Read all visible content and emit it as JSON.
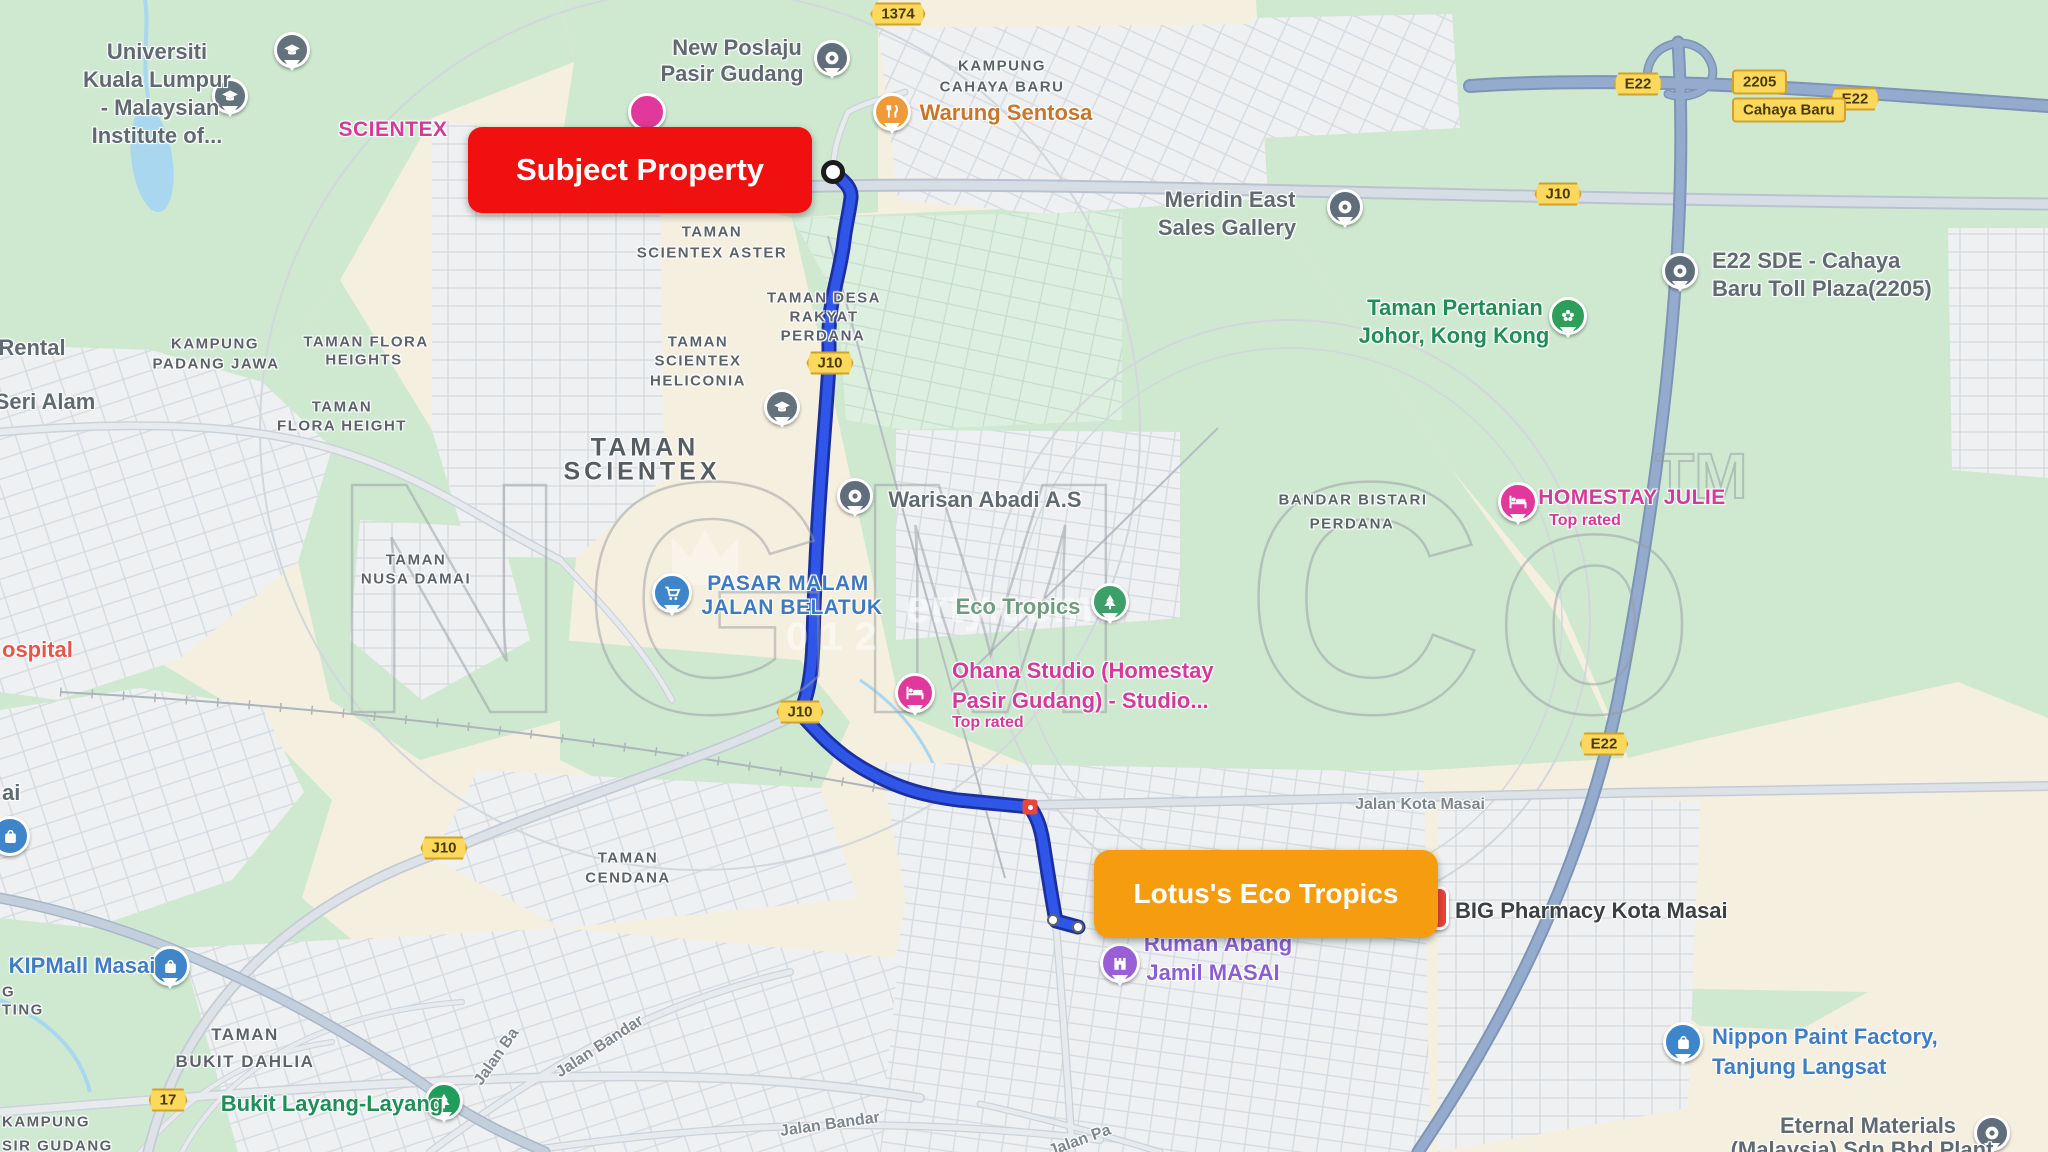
{
  "annotations": {
    "subject_property": "Subject Property",
    "lotus": "Lotus's Eco Tropics"
  },
  "shields": {
    "r1374": "1374",
    "e22": "E22",
    "r2205": "2205",
    "cahaya_baru": "Cahaya Baru",
    "j10": "J10",
    "r17": "17"
  },
  "watermark": {
    "part1": "NGM",
    "part2": "Co",
    "tm": "TM",
    "sub": "erty.com",
    "digits": "012"
  },
  "pois": {
    "universiti_l1": "Universiti",
    "universiti_l2": "Kuala Lumpur",
    "universiti_l3": "- Malaysian",
    "universiti_l4": "Institute of...",
    "new_poslaju_l1": "New Poslaju",
    "new_poslaju_l2": "Pasir Gudang",
    "warung": "Warung Sentosa",
    "scientex_partial": "SCIENTEX",
    "meridin_l1": "Meridin East",
    "meridin_l2": "Sales Gallery",
    "pertanian_l1": "Taman Pertanian",
    "pertanian_l2": "Johor, Kong Kong",
    "toll_l1": "E22 SDE - Cahaya",
    "toll_l2": "Baru Toll Plaza(2205)",
    "homestay_julie": "HOMESTAY JULIE",
    "top_rated": "Top rated",
    "warisan": "Warisan Abadi A.S",
    "pasar_l1": "PASAR MALAM",
    "pasar_l2": "JALAN BELATUK",
    "eco_tropics": "Eco Tropics",
    "ohana_l1": "Ohana Studio (Homestay",
    "ohana_l2": "Pasir Gudang) - Studio...",
    "big_pharmacy": "BIG Pharmacy Kota Masai",
    "ruman_l1": "Ruman Abang",
    "ruman_l2": "Jamil MASAI",
    "nippon_l1": "Nippon Paint Factory,",
    "nippon_l2": "Tanjung Langsat",
    "eternal_l1": "Eternal Materials",
    "eternal_l2": "(Malaysia) Sdn Bhd Plant",
    "kipmall": "KIPMall Masai",
    "bukit_layang": "Bukit Layang-Layang"
  },
  "areas": {
    "cahaya_l1": "KAMPUNG",
    "cahaya_l2": "CAHAYA BARU",
    "aster_l1": "TAMAN",
    "aster_l2": "SCIENTEX ASTER",
    "desa_l1": "TAMAN DESA",
    "desa_l2": "RAKYAT",
    "desa_l3": "PERDANA",
    "heliconia_l1": "TAMAN",
    "heliconia_l2": "SCIENTEX",
    "heliconia_l3": "HELICONIA",
    "scientex_l1": "TAMAN",
    "scientex_l2": "SCIENTEX",
    "bandar_l1": "BANDAR BISTARI",
    "bandar_l2": "PERDANA",
    "dahlia_l1": "TAMAN",
    "dahlia_l2": "BUKIT DAHLIA",
    "cendana_l1": "TAMAN",
    "cendana_l2": "CENDANA",
    "nusa_l1": "TAMAN",
    "nusa_l2": "NUSA DAMAI",
    "padang_l1": "KAMPUNG",
    "padang_l2": "PADANG JAWA",
    "flora_hts_l1": "TAMAN FLORA",
    "flora_hts_l2": "HEIGHTS",
    "flora_ht_l1": "TAMAN",
    "flora_ht_l2": "FLORA HEIGHT",
    "kampung_pg_l1": "KAMPUNG",
    "kampung_pg_l2": "SIR GUDANG"
  },
  "streets": {
    "kota_masai": "Jalan Kota Masai",
    "bandar": "Jalan Bandar",
    "pa": "Jalan Pa",
    "ba": "Jalan Ba"
  },
  "partials": {
    "rental": "Rental",
    "seri_alam": "Seri Alam",
    "ospital": "ospital",
    "ai": "ai",
    "g": "G",
    "ting": "TING"
  },
  "colors": {
    "route": "#2f56e8",
    "route_casing": "#1b2f9e",
    "highway": "#8fa6c6",
    "subject_box": "#f01010",
    "lotus_box": "#f59d0e",
    "shield_bg": "#fcd95c",
    "green_area": "#cfe9d1",
    "land_beige": "#f5efdf",
    "water": "#a9d7f0",
    "poi_pink": "#d33b9a",
    "poi_green": "#1f8e57",
    "poi_blue": "#3f7dc4"
  }
}
